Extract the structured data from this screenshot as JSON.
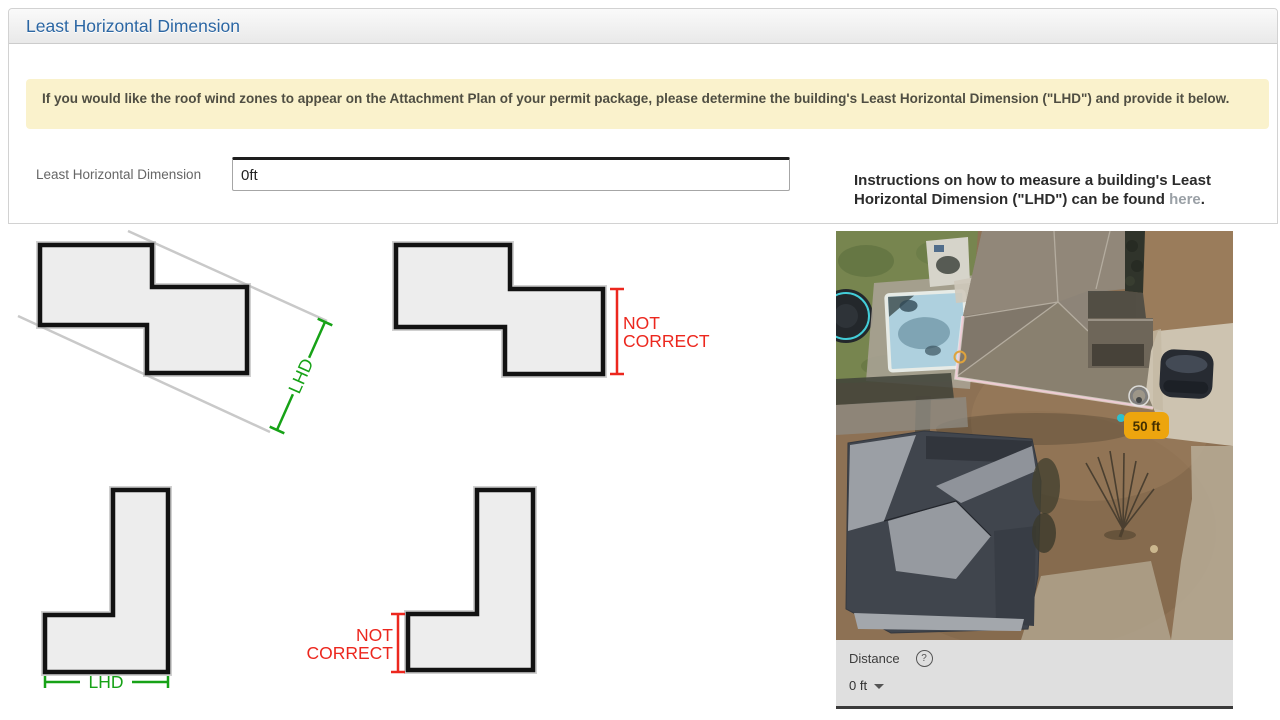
{
  "page": {
    "title": "Least Horizontal Dimension",
    "alert": "If you would like the roof wind zones to appear on the Attachment Plan of your permit package, please determine the building's Least Horizontal Dimension (\"LHD\") and provide it below.",
    "form": {
      "label": "Least Horizontal Dimension",
      "value": "0ft"
    },
    "instructions": {
      "text_before": "Instructions on how to measure a building's Least Horizontal Dimension (\"LHD\") can be found ",
      "link": "here",
      "text_after": "."
    }
  },
  "diagrams": {
    "rotated_z": {
      "label": "LHD"
    },
    "flat_z": {
      "label_line1": "NOT",
      "label_line2": "CORRECT"
    },
    "l_correct": {
      "label": "LHD"
    },
    "l_incorrect": {
      "label_line1": "NOT",
      "label_line2": "CORRECT"
    },
    "colors": {
      "correct_green": "#17a217",
      "incorrect_red": "#ec271e"
    }
  },
  "map": {
    "measurement_label": "50 ft",
    "colors": {
      "measurement_badge": "#eda50e"
    },
    "panel": {
      "distance_label": "Distance",
      "help_symbol": "?",
      "distance_value": "0 ft"
    }
  }
}
